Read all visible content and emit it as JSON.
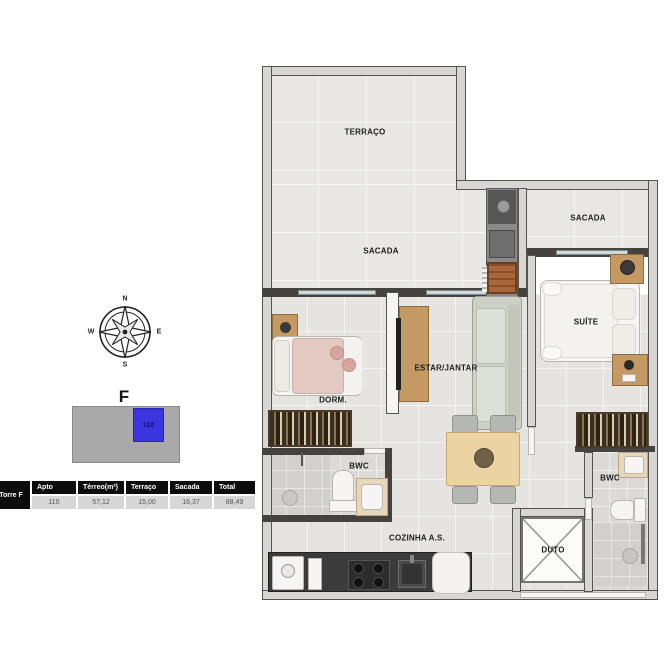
{
  "colors": {
    "key_blue": "#3b35e0",
    "table_header_bg": "#0c0c0c",
    "table_row_bg": "#d7d7d7",
    "wall_dark": "#454340",
    "balcony_floor": "#e9e7e3",
    "interior_floor": "#e6e4e1"
  },
  "legend": {
    "compass": {
      "north": "N",
      "south": "S",
      "east": "E",
      "west": "W"
    },
    "tower_label": "F",
    "key_unit_number": "110"
  },
  "summary_table": {
    "row_header": "Torre F",
    "columns": [
      "Apto",
      "Térreo(m²)",
      "Terraço",
      "Sacada",
      "Total"
    ],
    "row": [
      "110",
      "57,12",
      "15,00",
      "16,37",
      "88,49"
    ]
  },
  "floorplan": {
    "labels": {
      "terraco": "TERRAÇO",
      "sacada_main": "SACADA",
      "sacada_suite": "SACADA",
      "dorm": "DORM.",
      "estar_jantar": "ESTAR/JANTAR",
      "suite": "SUÍTE",
      "bwc_social": "BWC",
      "bwc_suite": "BWC",
      "cozinha_as": "COZINHA A.S.",
      "duto": "DUTO"
    }
  }
}
